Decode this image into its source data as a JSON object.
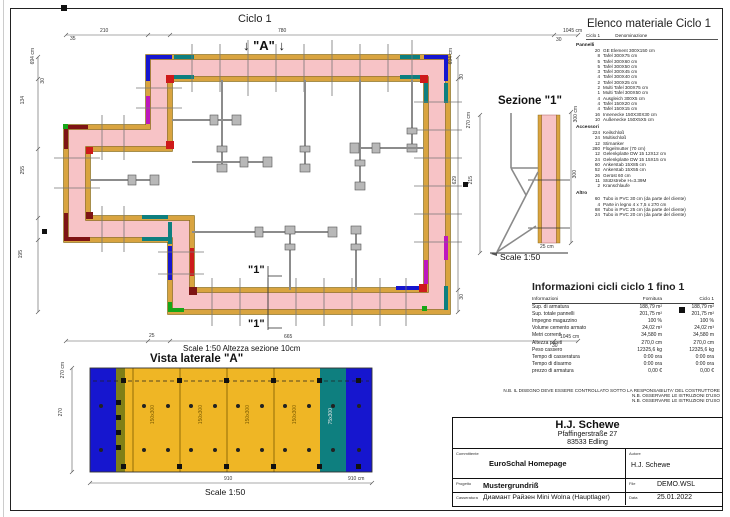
{
  "plan": {
    "title": "Ciclo 1",
    "arrow_glyph": "↓",
    "view_label": "\"A\"",
    "section_label": "\"1\"",
    "scale_note": "Scale 1:50   Altezza sezione 10cm",
    "dims": {
      "top": [
        "35",
        "210",
        "780",
        "30",
        "1045 cm"
      ],
      "bottom": [
        "25",
        "665",
        "30",
        "1045 cm"
      ],
      "left": [
        "694 cm",
        "30",
        "134",
        "255",
        "195"
      ],
      "right": [
        "694 cm",
        "30",
        "629",
        "30"
      ]
    }
  },
  "side_view": {
    "title": "Vista laterale \"A\"",
    "scale": "Scale 1:50",
    "panel_labels": [
      "150x300",
      "150x300",
      "150x300",
      "150x300",
      "75x300"
    ],
    "dims": {
      "height_total": "270 cm",
      "height": "270",
      "width": "910",
      "width_total": "910 cm"
    }
  },
  "section_view": {
    "title": "Sezione \"1\"",
    "scale": "Scale 1:50",
    "dims": {
      "height_total": "270 cm",
      "height": "215",
      "form_total": "300 cm",
      "form": "300",
      "width": "25 cm"
    }
  },
  "material_list": {
    "title": "Elenco materiale  Ciclo 1",
    "header_qty": "Ciclo 1",
    "header_name": "Denominazione",
    "groups": [
      {
        "name": "Pannelli",
        "items": [
          [
            "20",
            "GE Element 300X150 cm"
          ],
          [
            "8",
            "Tafel 300X75 cm"
          ],
          [
            "5",
            "Tafel 300X60 cm"
          ],
          [
            "5",
            "Tafel 300X50 cm"
          ],
          [
            "3",
            "Tafel 300X45 cm"
          ],
          [
            "4",
            "Tafel 300X40 cm"
          ],
          [
            "2",
            "Tafel 300X25 cm"
          ],
          [
            "2",
            "Multi Tafel 300X75 cm"
          ],
          [
            "1",
            "Multi Tafel 300X50 cm"
          ],
          [
            "4",
            "Ausgleich 300X5 cm"
          ],
          [
            "4",
            "Tafel 150X20 cm"
          ],
          [
            "4",
            "Tafel 150X15 cm"
          ],
          [
            "16",
            "Innenecke 150X30X30 cm"
          ],
          [
            "10",
            "Außenecke 150X5X5 cm"
          ]
        ]
      },
      {
        "name": "Accessori",
        "items": [
          [
            "224",
            "Keilschloß"
          ],
          [
            "24",
            "Multischloß"
          ],
          [
            "12",
            "Stirnanker"
          ],
          [
            "280",
            "Flügelmutter (70 cm)"
          ],
          [
            "12",
            "Gelenkplatte DW 15 12X12 cm"
          ],
          [
            "24",
            "Gelenkplatte DW 15 15X15 cm"
          ],
          [
            "60",
            "Ankerstab 15X85 cm"
          ],
          [
            "52",
            "Ankerstab 15X55 cm"
          ],
          [
            "26",
            "Gerüst 60 cm"
          ],
          [
            "11",
            "Stützstrebe H=3.39M"
          ],
          [
            "2",
            "Kranschlaufe"
          ]
        ]
      },
      {
        "name": "Altro",
        "items": [
          [
            "60",
            "Tubo in PVC 30 cm (da parte del cliente)"
          ],
          [
            "4",
            "Parte in legno 4 x 7,5 x 270 cm"
          ],
          [
            "68",
            "Tubo in PVC 25 cm (da parte del cliente)"
          ],
          [
            "24",
            "Tubo in PVC 20 cm (da parte del cliente)"
          ]
        ]
      }
    ]
  },
  "cycle_info": {
    "title": "Informazioni cicli  ciclo 1 fino 1",
    "columns": [
      "Informazioni",
      "Fornitura",
      "Ciclo 1"
    ],
    "rows": [
      [
        "Sup. di armatura",
        "188,79 m²",
        "188,79 m²"
      ],
      [
        "Sup. totale pannelli",
        "201,75 m²",
        "201,75 m²"
      ],
      [
        "Impegno magazzino",
        "100 %",
        "100 %"
      ],
      [
        "Volume cemento armato",
        "24,02 m³",
        "24,02 m³"
      ],
      [
        "Metri correnti",
        "34,580 m",
        "34,580 m"
      ],
      [
        "Altezza pareti",
        "270,0 cm",
        "270,0 cm"
      ],
      [
        "Peso cassero",
        "12325,6 kg",
        "12325,6 kg"
      ],
      [
        "Tempo di casseratura",
        "0:00 ora",
        "0:00 ora"
      ],
      [
        "Tempo di disarmo",
        "0:00 ora",
        "0:00 ora"
      ],
      [
        "prezzo di armatura",
        "0,00 €",
        "0,00 €"
      ]
    ]
  },
  "notes": [
    "N.B. IL DISEGNO DEVE ESSERE CONTROLLATO SOTTO LA RESPONSABILITA' DEL COSTRUTTORE",
    "N.B. OSSERVARE LE ISTRUZIONI D'USO",
    "N.B. OSSERVARE LE ISTRUZIONI D'USO"
  ],
  "title_block": {
    "company": "H.J. Schewe",
    "address_line1": "Pfaffingerstraße 27",
    "address_line2": "83533 Edling",
    "committente_label": "Committente",
    "committente": "EuroSchal Homepage",
    "autore_label": "Autore",
    "autore": "H.J. Schewe",
    "progetto_label": "Progetto",
    "progetto": "Mustergrundriß",
    "file_label": "File",
    "file": "DEMO.WSL",
    "casseratura_label": "Casseratura",
    "casseratura": "Диамант Райзен Mini Wolna (Hauptlager)",
    "data_label": "Data",
    "data": "25.01.2022"
  },
  "colors": {
    "panel_yellow": "#D9A440",
    "panel_yellow_bright": "#EFB625",
    "concrete_pink": "#F7C3C6",
    "teal": "#0E7F7F",
    "blue": "#1616CF",
    "red": "#CE1A1A",
    "dark_red": "#7E1414",
    "magenta": "#BE17BE",
    "green": "#17A617",
    "olive": "#7F7F17",
    "brace_gray": "#8C8C8C"
  }
}
